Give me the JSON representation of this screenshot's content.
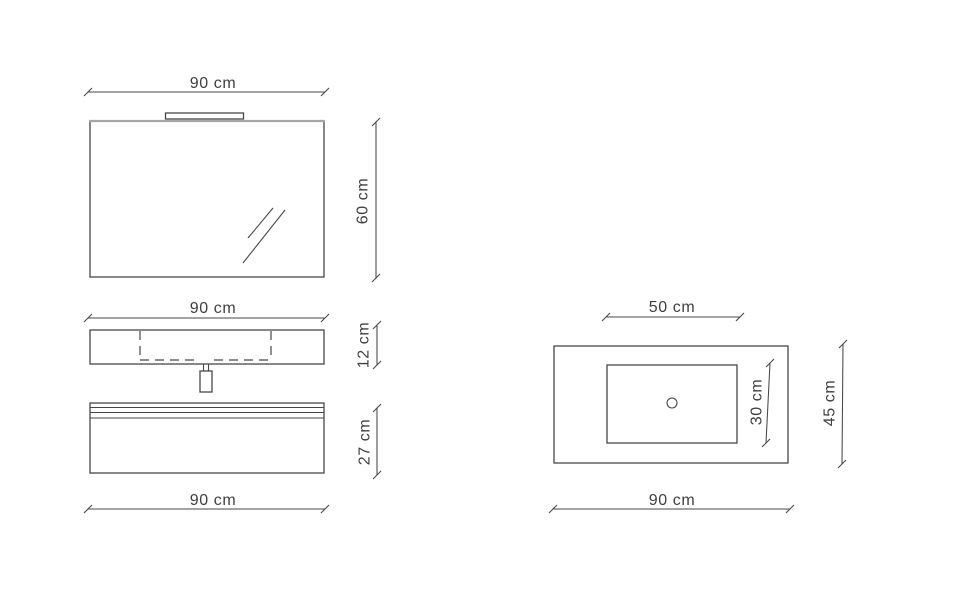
{
  "drawing": {
    "front_view": {
      "mirror": {
        "width_label": "90 cm",
        "height_label": "60 cm"
      },
      "washbasin_unit": {
        "width_label": "90 cm",
        "height_label": "12 cm"
      },
      "base_cabinet": {
        "width_label": "90 cm",
        "height_label": "27 cm"
      }
    },
    "top_view": {
      "basin": {
        "width_label": "50 cm",
        "depth_label": "30 cm"
      },
      "countertop": {
        "width_label": "90 cm",
        "depth_label": "45 cm"
      }
    },
    "colors": {
      "line": "#474747",
      "text": "#3f3f3f",
      "mirror_top_edge": "#a6a6a6",
      "background": "#ffffff"
    }
  }
}
